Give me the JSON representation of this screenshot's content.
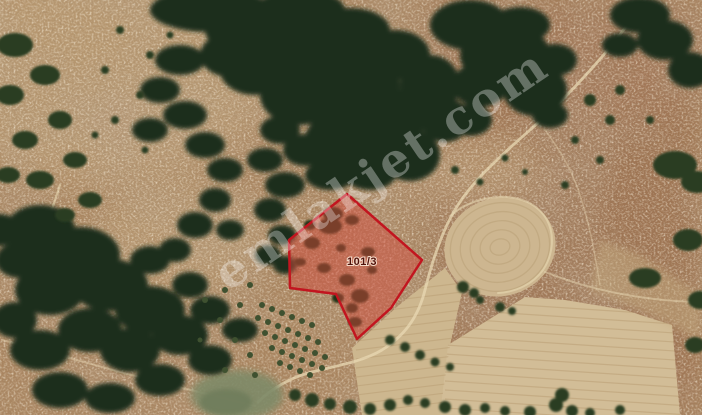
{
  "map": {
    "watermark": {
      "text": "emlakjet.com",
      "color": "#ffffff",
      "opacity": 0.32
    },
    "parcel": {
      "label": "101/3",
      "outline_color": "#c2151f",
      "fill_color": "rgba(210,75,62,0.5)",
      "label_color": "#4f120b"
    }
  }
}
